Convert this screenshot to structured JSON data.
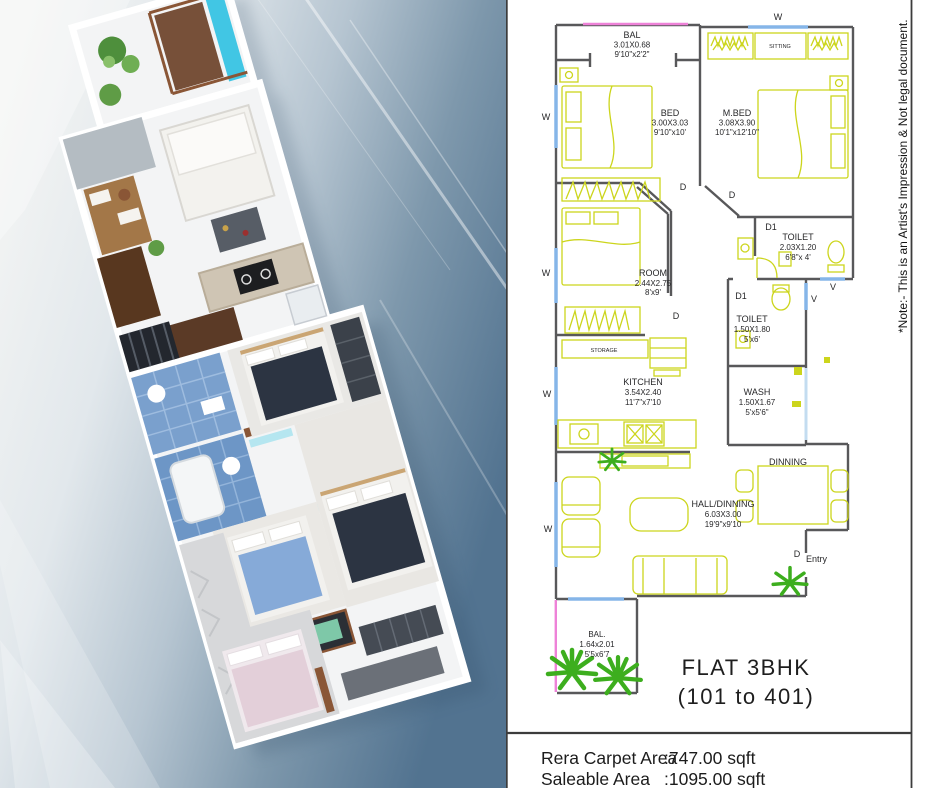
{
  "plan": {
    "rooms": [
      {
        "name": "BAL",
        "m": "3.01X0.68",
        "ft": "9'10\"x2'2\""
      },
      {
        "name": "BED",
        "m": "3.00X3.03",
        "ft": "9'10\"x10'"
      },
      {
        "name": "M.BED",
        "m": "3.08X3.90",
        "ft": "10'1\"x12'10\""
      },
      {
        "name": "TOILET",
        "m": "2.03X1.20",
        "ft": "6'8\"x 4'"
      },
      {
        "name": "TOILET",
        "m": "1.50X1.80",
        "ft": "5'x6'"
      },
      {
        "name": "ROOM",
        "m": "2.44X2.75",
        "ft": "8'x9'"
      },
      {
        "name": "WASH",
        "m": "1.50X1.67",
        "ft": "5'x5'6\""
      },
      {
        "name": "KITCHEN",
        "m": "3.54X2.40",
        "ft": "11'7\"x7'10"
      },
      {
        "name": "HALL/DINNING",
        "m": "6.03X3.00",
        "ft": "19'9\"x9'10"
      },
      {
        "name": "BAL.",
        "m": "1.64x2.01",
        "ft": "5'5x6'7"
      }
    ],
    "zones": {
      "sitting": "SITTING",
      "storage": "STORAGE",
      "dinning": "DINNING"
    },
    "markers": [
      "W",
      "W",
      "W",
      "W",
      "W",
      "V",
      "V",
      "D",
      "D",
      "D",
      "D",
      "D1",
      "D1",
      "Entry"
    ],
    "title_line1": "FLAT 3BHK",
    "title_line2": "(101 to 401)"
  },
  "footer": {
    "rera_label": "Rera Carpet Area",
    "rera_value": ":747.00 sqft",
    "saleable_label": "Saleable Area",
    "saleable_value": ":1095.00 sqft"
  },
  "note": "*Note:- This is an Artist's Impression & Not legal document.",
  "colors": {
    "wall": "#58585a",
    "furniture": "#ccd51c",
    "window": "#85b5e8",
    "balcony_edge_pink": "#ee82d8",
    "plant_green": "#3dae1e"
  }
}
